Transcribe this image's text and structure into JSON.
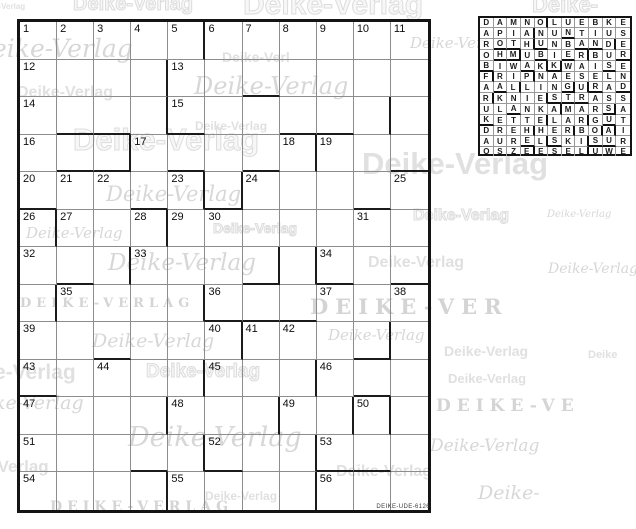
{
  "puzzle": {
    "rows": 13,
    "cols": 11,
    "code_text": "DEIKE-UDE-6126",
    "numbers": [
      [
        1,
        1,
        "1"
      ],
      [
        1,
        2,
        "2"
      ],
      [
        1,
        3,
        "3"
      ],
      [
        1,
        4,
        "4"
      ],
      [
        1,
        5,
        "5"
      ],
      [
        1,
        6,
        "6"
      ],
      [
        1,
        7,
        "7"
      ],
      [
        1,
        8,
        "8"
      ],
      [
        1,
        9,
        "9"
      ],
      [
        1,
        10,
        "10"
      ],
      [
        1,
        11,
        "11"
      ],
      [
        2,
        1,
        "12"
      ],
      [
        2,
        5,
        "13"
      ],
      [
        3,
        1,
        "14"
      ],
      [
        3,
        5,
        "15"
      ],
      [
        4,
        1,
        "16"
      ],
      [
        4,
        4,
        "17"
      ],
      [
        4,
        8,
        "18"
      ],
      [
        4,
        9,
        "19"
      ],
      [
        5,
        1,
        "20"
      ],
      [
        5,
        2,
        "21"
      ],
      [
        5,
        3,
        "22"
      ],
      [
        5,
        5,
        "23"
      ],
      [
        5,
        7,
        "24"
      ],
      [
        5,
        11,
        "25"
      ],
      [
        6,
        1,
        "26"
      ],
      [
        6,
        2,
        "27"
      ],
      [
        6,
        4,
        "28"
      ],
      [
        6,
        5,
        "29"
      ],
      [
        6,
        6,
        "30"
      ],
      [
        6,
        10,
        "31"
      ],
      [
        7,
        1,
        "32"
      ],
      [
        7,
        4,
        "33"
      ],
      [
        7,
        9,
        "34"
      ],
      [
        8,
        2,
        "35"
      ],
      [
        8,
        6,
        "36"
      ],
      [
        8,
        9,
        "37"
      ],
      [
        8,
        11,
        "38"
      ],
      [
        9,
        1,
        "39"
      ],
      [
        9,
        6,
        "40"
      ],
      [
        9,
        7,
        "41"
      ],
      [
        9,
        8,
        "42"
      ],
      [
        10,
        1,
        "43"
      ],
      [
        10,
        3,
        "44"
      ],
      [
        10,
        6,
        "45"
      ],
      [
        10,
        9,
        "46"
      ],
      [
        11,
        1,
        "47"
      ],
      [
        11,
        5,
        "48"
      ],
      [
        11,
        8,
        "49"
      ],
      [
        11,
        10,
        "50"
      ],
      [
        12,
        1,
        "51"
      ],
      [
        12,
        6,
        "52"
      ],
      [
        12,
        9,
        "53"
      ],
      [
        13,
        1,
        "54"
      ],
      [
        13,
        5,
        "55"
      ],
      [
        13,
        9,
        "56"
      ]
    ],
    "thick_below": [
      [
        2,
        7
      ],
      [
        3,
        2
      ],
      [
        3,
        3
      ],
      [
        3,
        5
      ],
      [
        3,
        8
      ],
      [
        3,
        9
      ],
      [
        4,
        2
      ],
      [
        4,
        3
      ],
      [
        4,
        5
      ],
      [
        4,
        7
      ],
      [
        4,
        11
      ],
      [
        5,
        1
      ],
      [
        5,
        4
      ],
      [
        5,
        6
      ],
      [
        5,
        10
      ],
      [
        7,
        2
      ],
      [
        7,
        7
      ],
      [
        7,
        9
      ],
      [
        7,
        11
      ],
      [
        8,
        6
      ],
      [
        8,
        7
      ],
      [
        8,
        8
      ],
      [
        9,
        3
      ],
      [
        9,
        10
      ],
      [
        10,
        1
      ],
      [
        10,
        10
      ],
      [
        12,
        4
      ],
      [
        12,
        6
      ],
      [
        12,
        9
      ],
      [
        12,
        10
      ]
    ],
    "thick_right": [
      [
        1,
        5
      ],
      [
        2,
        4
      ],
      [
        3,
        4
      ],
      [
        3,
        10
      ],
      [
        4,
        3
      ],
      [
        4,
        8
      ],
      [
        5,
        5
      ],
      [
        5,
        6
      ],
      [
        6,
        1
      ],
      [
        6,
        4
      ],
      [
        7,
        3
      ],
      [
        7,
        7
      ],
      [
        7,
        8
      ],
      [
        8,
        1
      ],
      [
        8,
        5
      ],
      [
        9,
        6
      ],
      [
        9,
        10
      ],
      [
        10,
        5
      ],
      [
        10,
        8
      ],
      [
        11,
        4
      ],
      [
        11,
        7
      ],
      [
        11,
        9
      ],
      [
        11,
        10
      ],
      [
        12,
        5
      ],
      [
        12,
        8
      ],
      [
        13,
        4
      ],
      [
        13,
        8
      ]
    ]
  },
  "solution": {
    "rows": [
      "DAMNOLUEBKE",
      "APIANUNTIUS",
      "ROTHUNBANDE",
      "OHMUBIERBUR",
      "BIWAKKWAISE",
      "FRIPNAESELN",
      "AALLINGURAD",
      "RKNIESTRASS",
      "ULANKAMARSA",
      "KETTELARGUT",
      "DREHHERBOAI",
      "AURELSKISUR",
      "OSZEESELUWE"
    ]
  },
  "watermarks": [
    {
      "text": "e-Verlag",
      "style": "bold",
      "x": -6,
      "y": 3,
      "size": 8
    },
    {
      "text": "Deike-Verlag",
      "style": "outline",
      "x": 73,
      "y": -6,
      "size": 20
    },
    {
      "text": "Deike-Verlag",
      "style": "outline",
      "x": 243,
      "y": -10,
      "size": 30
    },
    {
      "text": "Deike-",
      "style": "outline",
      "x": 532,
      "y": -6,
      "size": 22
    },
    {
      "text": "eike-Verlag",
      "style": "script",
      "x": -8,
      "y": 36,
      "size": 25
    },
    {
      "text": "Deike-Verl",
      "style": "bold",
      "x": 222,
      "y": 50,
      "size": 14
    },
    {
      "text": "Deike-Ver",
      "style": "script",
      "x": 410,
      "y": 36,
      "size": 15
    },
    {
      "text": "Deike-Verlag",
      "style": "bold",
      "x": 17,
      "y": 85,
      "size": 16
    },
    {
      "text": "Deike-Verlag",
      "style": "script",
      "x": 194,
      "y": 74,
      "size": 24
    },
    {
      "text": "Deike-Verlag",
      "style": "outline",
      "x": 73,
      "y": 124,
      "size": 31
    },
    {
      "text": "Deike-Verlag",
      "style": "bold",
      "x": 195,
      "y": 120,
      "size": 12
    },
    {
      "text": "Deike-Verlag",
      "style": "bold",
      "x": 362,
      "y": 148,
      "size": 31
    },
    {
      "text": "Deike-Verlag",
      "style": "script",
      "x": 106,
      "y": 184,
      "size": 21
    },
    {
      "text": "Deike-Verlag",
      "style": "outline",
      "x": 413,
      "y": 208,
      "size": 16
    },
    {
      "text": "Deike-Verlag",
      "style": "script",
      "x": 547,
      "y": 210,
      "size": 10
    },
    {
      "text": "Deike-Verlag",
      "style": "script",
      "x": 26,
      "y": 226,
      "size": 15
    },
    {
      "text": "Deike-Verlag",
      "style": "outline",
      "x": 213,
      "y": 221,
      "size": 14
    },
    {
      "text": "Deike-Verlag",
      "style": "script",
      "x": 108,
      "y": 252,
      "size": 23
    },
    {
      "text": "Deike-Verlag",
      "style": "bold",
      "x": 368,
      "y": 255,
      "size": 16
    },
    {
      "text": "Deike-Verlag",
      "style": "script",
      "x": 548,
      "y": 262,
      "size": 14
    },
    {
      "text": "DEIKE-VERLAG",
      "style": "caps",
      "x": 20,
      "y": 297,
      "size": 13,
      "spacing": 5
    },
    {
      "text": "DEIKE-VER",
      "style": "caps",
      "x": 310,
      "y": 296,
      "size": 21,
      "spacing": 7
    },
    {
      "text": "Deike-Verlag",
      "style": "script",
      "x": 328,
      "y": 328,
      "size": 15
    },
    {
      "text": "Deike-Verlag",
      "style": "script",
      "x": 92,
      "y": 332,
      "size": 19
    },
    {
      "text": "Deike-Verlag",
      "style": "bold",
      "x": 444,
      "y": 344,
      "size": 14
    },
    {
      "text": "Deike",
      "style": "bold",
      "x": 588,
      "y": 350,
      "size": 11
    },
    {
      "text": "e-Verlag",
      "style": "bold",
      "x": -6,
      "y": 362,
      "size": 21
    },
    {
      "text": "Deike-Verlag",
      "style": "outline",
      "x": 146,
      "y": 362,
      "size": 19
    },
    {
      "text": "Deike-Verlag",
      "style": "bold",
      "x": 448,
      "y": 372,
      "size": 13
    },
    {
      "text": "ke-Verlag",
      "style": "script",
      "x": -6,
      "y": 394,
      "size": 19
    },
    {
      "text": "DEIKE-VE",
      "style": "caps",
      "x": 436,
      "y": 398,
      "size": 17,
      "spacing": 6
    },
    {
      "text": "Deike-Verlag",
      "style": "script",
      "x": 128,
      "y": 424,
      "size": 27
    },
    {
      "text": "Deike-Verlag",
      "style": "script",
      "x": 430,
      "y": 438,
      "size": 17
    },
    {
      "text": "-Verlag",
      "style": "bold",
      "x": -8,
      "y": 458,
      "size": 17
    },
    {
      "text": "Deike-Verlag",
      "style": "bold",
      "x": 336,
      "y": 464,
      "size": 16
    },
    {
      "text": "Deike-Verlag",
      "style": "bold",
      "x": 205,
      "y": 490,
      "size": 12
    },
    {
      "text": "Deike-",
      "style": "script",
      "x": 478,
      "y": 484,
      "size": 19
    },
    {
      "text": "DEIKE-VERLAG",
      "style": "caps",
      "x": 50,
      "y": 500,
      "size": 14,
      "spacing": 5
    }
  ],
  "colors": {
    "page_bg": "#ffffff",
    "grid_frame": "#141414",
    "thin_line": "#8d8d8d",
    "thick_line": "#1b1b1b",
    "number_text": "#0d0d0d",
    "letter_text": "#1a1a1a",
    "watermark_gray": "#dddddd"
  }
}
